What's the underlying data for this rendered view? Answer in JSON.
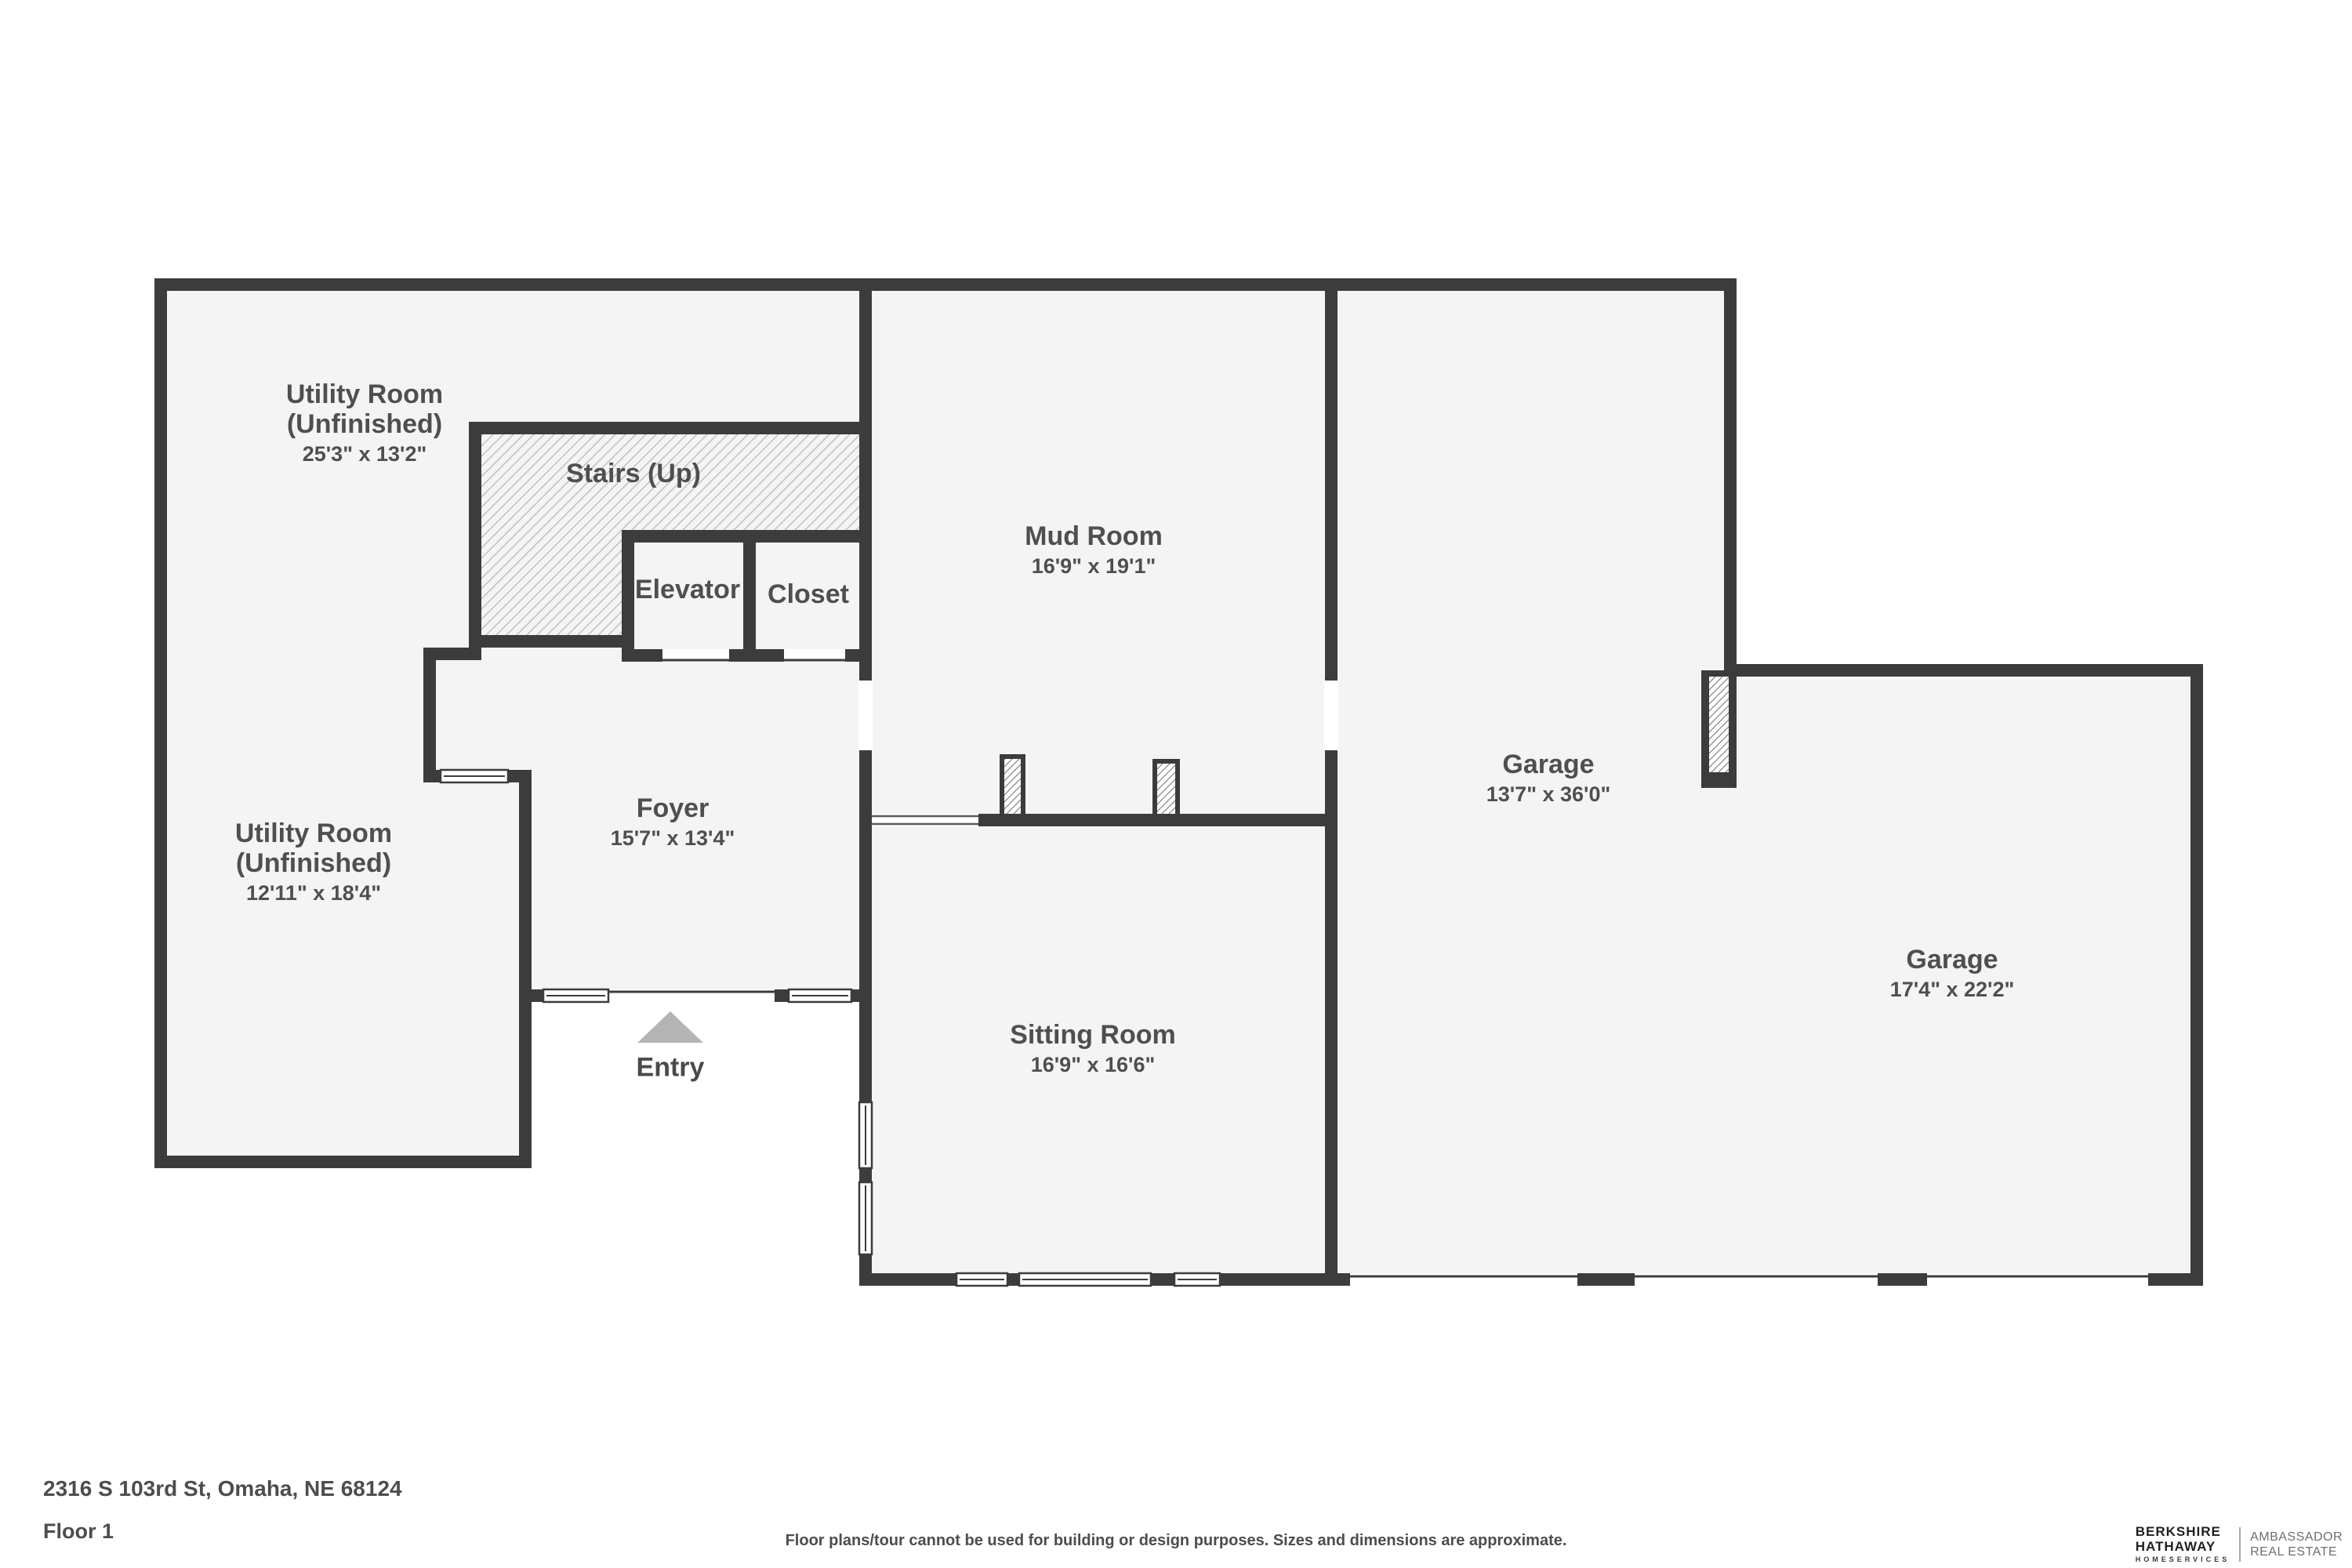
{
  "plan": {
    "title": "Floor plan — Floor 1",
    "rooms": [
      {
        "id": "utility-room-upper",
        "name": "Utility Room\n(Unfinished)",
        "dims": "25'3\" x 13'2\""
      },
      {
        "id": "stairs",
        "name": "Stairs (Up)",
        "dims": ""
      },
      {
        "id": "elevator",
        "name": "Elevator",
        "dims": ""
      },
      {
        "id": "closet",
        "name": "Closet",
        "dims": ""
      },
      {
        "id": "mud-room",
        "name": "Mud Room",
        "dims": "16'9\" x 19'1\""
      },
      {
        "id": "garage-tandem",
        "name": "Garage",
        "dims": "13'7\" x 36'0\""
      },
      {
        "id": "garage",
        "name": "Garage",
        "dims": "17'4\" x 22'2\""
      },
      {
        "id": "utility-room-lower",
        "name": "Utility Room\n(Unfinished)",
        "dims": "12'11\" x 18'4\""
      },
      {
        "id": "foyer",
        "name": "Foyer",
        "dims": "15'7\" x 13'4\""
      },
      {
        "id": "sitting-room",
        "name": "Sitting Room",
        "dims": "16'9\" x 16'6\""
      }
    ],
    "entry_label": "Entry"
  },
  "footer": {
    "address": "2316 S 103rd St, Omaha, NE 68124",
    "floor_label": "Floor 1",
    "disclaimer": "Floor plans/tour cannot be used for building or design purposes. Sizes and dimensions are approximate."
  },
  "branding": {
    "brand_line1": "BERKSHIRE",
    "brand_line2": "HATHAWAY",
    "brand_line3": "HOMESERVICES",
    "partner_line1": "AMBASSADOR",
    "partner_line2": "REAL ESTATE"
  },
  "colors": {
    "wall": "#3c3c3c",
    "floor": "#f4f4f4",
    "hatch_line": "#c3c3c3",
    "label_text": "#4f4f4f",
    "entry_arrow": "#b4b4b4",
    "background": "#ffffff"
  }
}
